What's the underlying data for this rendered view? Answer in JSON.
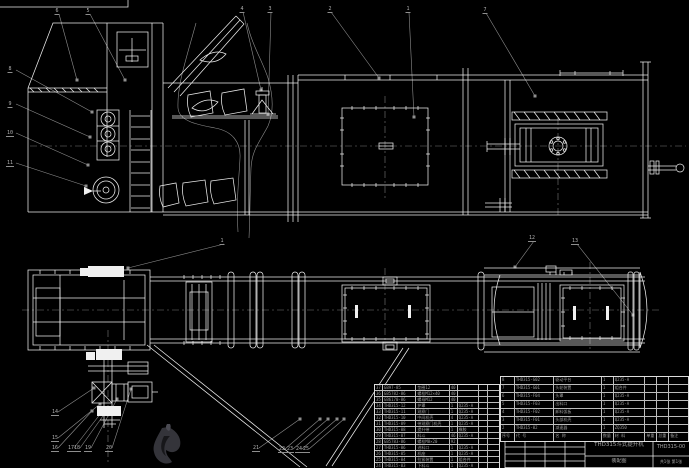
{
  "meta": {
    "background": "#000000",
    "line_color": "#ececec",
    "annotation_color": "#8e8e8e",
    "text_color": "#9c9c9c"
  },
  "title_block": {
    "product": "THD315斗式提升机",
    "drawing_type": "装配图",
    "drawing_no": "THD315-00",
    "sheet_info": "共1张 第1张"
  },
  "balloons": [
    {
      "n": "6",
      "x": 57,
      "y": 8
    },
    {
      "n": "5",
      "x": 88,
      "y": 8
    },
    {
      "n": "4",
      "x": 242,
      "y": 6
    },
    {
      "n": "3",
      "x": 270,
      "y": 6
    },
    {
      "n": "2",
      "x": 330,
      "y": 6
    },
    {
      "n": "1",
      "x": 408,
      "y": 6
    },
    {
      "n": "7",
      "x": 485,
      "y": 7
    },
    {
      "n": "8",
      "x": 10,
      "y": 66
    },
    {
      "n": "9",
      "x": 10,
      "y": 101
    },
    {
      "n": "10",
      "x": 10,
      "y": 130
    },
    {
      "n": "11",
      "x": 10,
      "y": 160
    },
    {
      "n": "1",
      "x": 222,
      "y": 238
    },
    {
      "n": "12",
      "x": 532,
      "y": 235
    },
    {
      "n": "13",
      "x": 575,
      "y": 238
    },
    {
      "n": "14",
      "x": 55,
      "y": 409
    },
    {
      "n": "15",
      "x": 55,
      "y": 435
    },
    {
      "n": "16",
      "x": 55,
      "y": 445
    },
    {
      "n": "17",
      "x": 71,
      "y": 445
    },
    {
      "n": "18",
      "x": 77,
      "y": 445
    },
    {
      "n": "19",
      "x": 88,
      "y": 445
    },
    {
      "n": "20",
      "x": 109,
      "y": 445
    },
    {
      "n": "21",
      "x": 256,
      "y": 445
    },
    {
      "n": "22",
      "x": 282,
      "y": 446
    },
    {
      "n": "23",
      "x": 290,
      "y": 446
    },
    {
      "n": "24",
      "x": 299,
      "y": 446
    },
    {
      "n": "25",
      "x": 306,
      "y": 446
    }
  ],
  "bom_left": {
    "x": 374,
    "y": 384,
    "w": 126,
    "row_h": 6,
    "cols": [
      8,
      34,
      34,
      8,
      22,
      9,
      11
    ],
    "rows": [
      [
        "37",
        "GB97-85",
        "垫圈12",
        "40",
        "",
        "",
        ""
      ],
      [
        "36",
        "GB5782-86",
        "螺栓M12×40",
        "40",
        "",
        "",
        ""
      ],
      [
        "35",
        "GB6170-86",
        "螺母M12",
        "40",
        "",
        "",
        ""
      ],
      [
        "34",
        "THD315-12",
        "护罩",
        "1",
        "Q235-A",
        "",
        ""
      ],
      [
        "33",
        "THD315-11",
        "观察门",
        "1",
        "Q235-A",
        "",
        ""
      ],
      [
        "32",
        "THD315-10",
        "中间机壳",
        "4",
        "Q235-A",
        "",
        ""
      ],
      [
        "31",
        "THD315-09",
        "带观察门机壳",
        "1",
        "Q235-A",
        "",
        ""
      ],
      [
        "30",
        "THD315-08",
        "提升带",
        "1",
        "橡胶",
        "",
        ""
      ],
      [
        "29",
        "THD315-07",
        "料斗",
        "46",
        "Q235-A",
        "",
        ""
      ],
      [
        "28",
        "GB5783-86",
        "螺栓M8×20",
        "92",
        "",
        "",
        ""
      ],
      [
        "27",
        "THD315-06",
        "进料口",
        "1",
        "Q235-A",
        "",
        ""
      ],
      [
        "26",
        "THD315-05",
        "机座",
        "1",
        "Q235-A",
        "",
        ""
      ],
      [
        "25",
        "THD315-04",
        "拉紧装置",
        "1",
        "组合件",
        "",
        ""
      ],
      [
        "24",
        "THD315-03",
        "下料斗",
        "1",
        "Q235-A",
        "",
        ""
      ]
    ]
  },
  "bom_right": {
    "x": 500,
    "y": 376,
    "w": 189,
    "row_h": 8,
    "cols": [
      14,
      40,
      48,
      12,
      32,
      12,
      12,
      19
    ],
    "rows": [
      [
        "8",
        "THD315-G02",
        "驱动平台",
        "1",
        "Q235-A",
        "",
        "",
        ""
      ],
      [
        "7",
        "THD315-G01",
        "头轮装置",
        "1",
        "组合件",
        "",
        "",
        ""
      ],
      [
        "6",
        "THD315-F04",
        "头罩",
        "1",
        "Q235-A",
        "",
        "",
        ""
      ],
      [
        "5",
        "THD315-F03",
        "出料口",
        "1",
        "Q235-A",
        "",
        "",
        ""
      ],
      [
        "4",
        "THD315-F02",
        "卸料弧板",
        "1",
        "Q235-A",
        "",
        "",
        ""
      ],
      [
        "3",
        "THD315-F01",
        "头部机壳",
        "1",
        "Q235-A",
        "",
        "",
        ""
      ],
      [
        "2",
        "THD315-02",
        "减速器",
        "1",
        "ZQ350",
        "",
        "",
        ""
      ],
      [
        "序号",
        "代 号",
        "名 称",
        "数量",
        "材 料",
        "单重",
        "总重",
        "备注"
      ]
    ]
  }
}
